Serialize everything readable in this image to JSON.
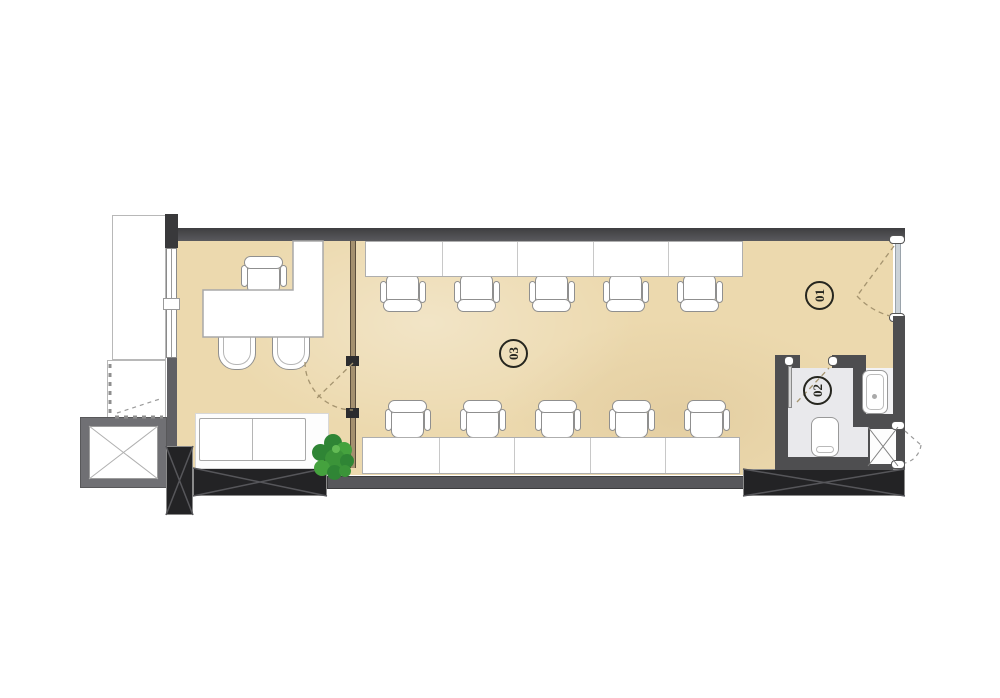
{
  "plan": {
    "rooms": [
      {
        "name": "entry-hall",
        "label": "01"
      },
      {
        "name": "bathroom",
        "label": "02"
      },
      {
        "name": "open-office",
        "label": "03"
      }
    ],
    "furniture": {
      "workstations_top": 5,
      "workstations_bottom": 5,
      "manager_desk": "L-shaped",
      "manager_chairs": 1,
      "guest_chairs": 2,
      "sofa_seats": 2,
      "toilets": 1,
      "sinks": 1,
      "plants": 1,
      "elevators": 1
    },
    "colors": {
      "floor_beige": "#ecd9ae",
      "wall_dark": "#4e4e50",
      "wall_black": "#232325",
      "bathroom_floor": "#e9e9ec",
      "plant_green": "#3f9239",
      "furniture_white": "#ffffff"
    }
  }
}
